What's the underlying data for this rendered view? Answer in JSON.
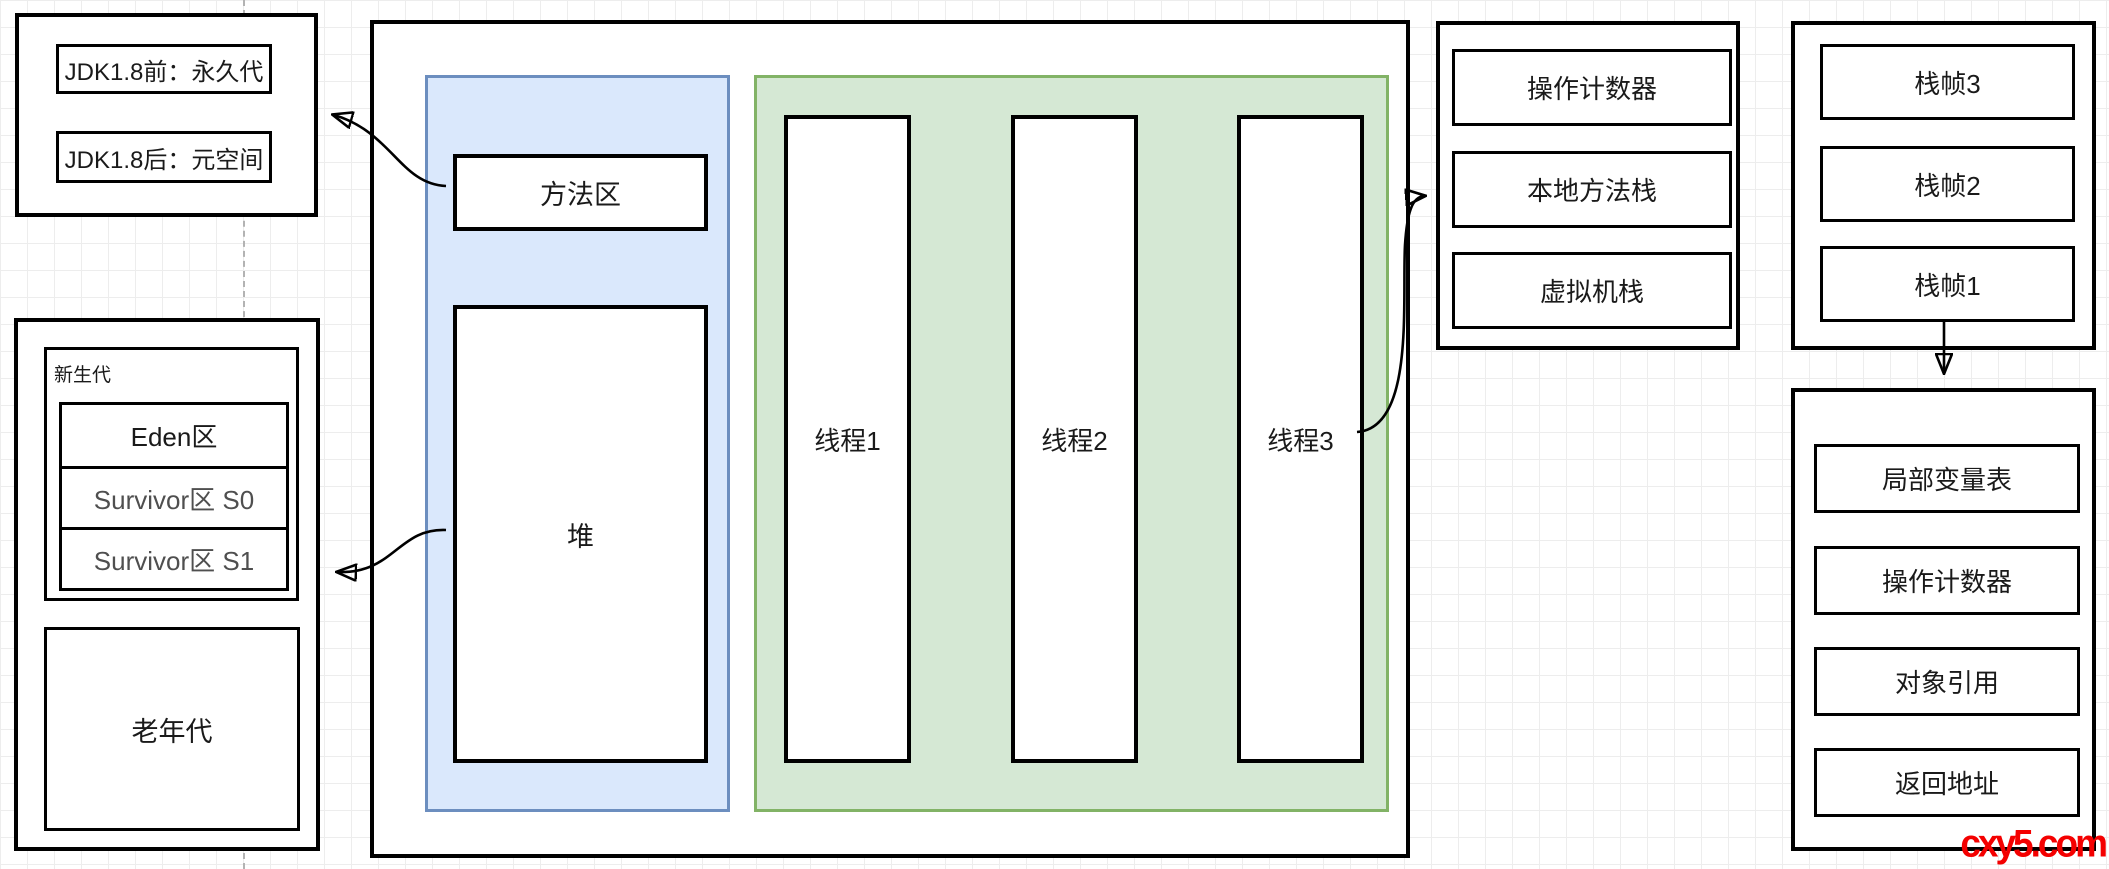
{
  "diagram": {
    "note_box": {
      "items": [
        "JDK1.8前：永久代",
        "JDK1.8后：元空间"
      ]
    },
    "generation_box": {
      "new_gen_label": "新生代",
      "rows": [
        "Eden区",
        "Survivor区 S0",
        "Survivor区 S1"
      ],
      "old_gen_label": "老年代"
    },
    "jvm_box": {
      "method_area_label": "方法区",
      "heap_label": "堆",
      "threads": [
        "线程1",
        "线程2",
        "线程3"
      ]
    },
    "thread_stack_box": {
      "rows": [
        "操作计数器",
        "本地方法栈",
        "虚拟机栈"
      ]
    },
    "stack_frames_box": {
      "rows": [
        "栈帧3",
        "栈帧2",
        "栈帧1"
      ]
    },
    "frame_detail_box": {
      "rows": [
        "局部变量表",
        "操作计数器",
        "对象引用",
        "返回地址"
      ]
    },
    "watermark": "cxy5.com",
    "colors": {
      "region_blue_fill": "#dae8fc",
      "region_blue_border": "#6c8ebf",
      "region_green_fill": "#d5e8d4",
      "region_green_border": "#82b366",
      "box_border": "#000000",
      "watermark_red": "#f40000",
      "dashed_guide": "#b3b3b3",
      "grid_line": "#ededed"
    }
  }
}
